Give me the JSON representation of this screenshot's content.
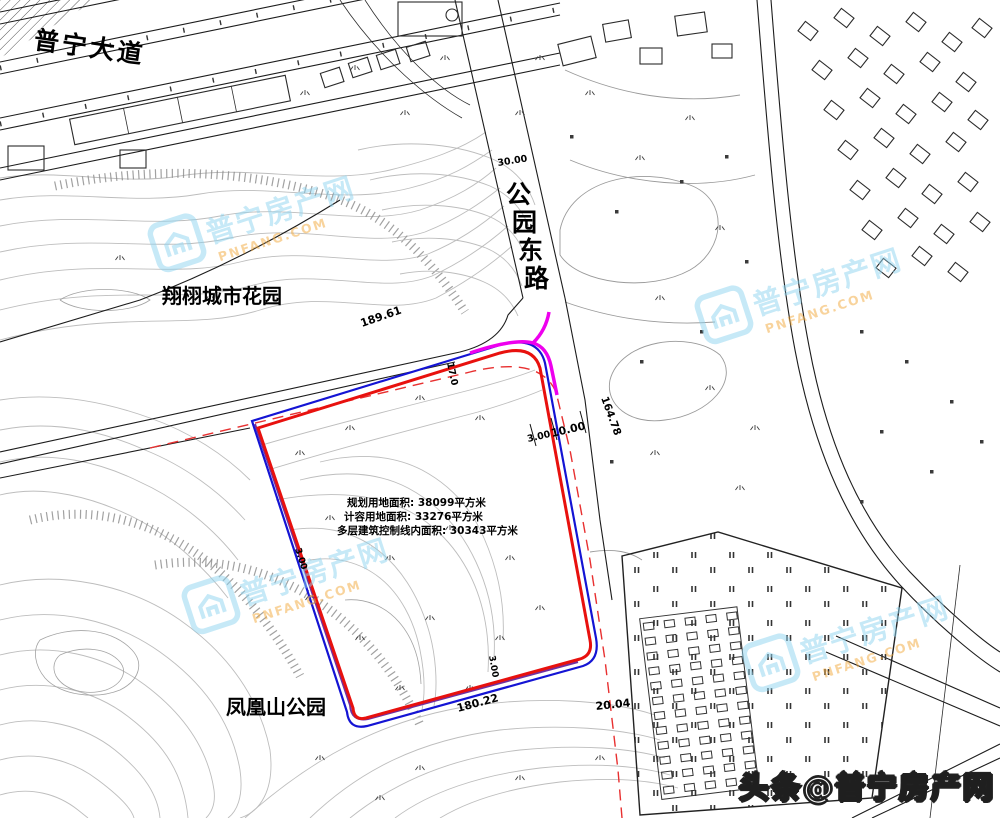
{
  "watermark": {
    "cn": "普宁房产网",
    "en": "PNFANG.COM"
  },
  "credit": {
    "text": "头条@普宁房产网"
  },
  "map": {
    "roads": {
      "puning_avenue": "普宁大道",
      "park_east_road_chars": [
        "公",
        "园",
        "东",
        "路"
      ]
    },
    "places": {
      "city_garden": "翔栩城市花园",
      "phoenix_park": "凤凰山公园"
    },
    "site_annotation": {
      "line1": "规划用地面积: 38099平方米",
      "line2": "计容用地面积: 33276平方米",
      "line3": "多层建筑控制线内面积: 30343平方米"
    },
    "dimensions": {
      "top_edge_length": "189.61",
      "road_width": "30.00",
      "setback_3": "3.00",
      "setback_10": "10.00",
      "east_edge_length": "164.78",
      "north_setback": "17.0",
      "west_setback": "3.00",
      "south_setback": "3.00",
      "south_edge_length": "180.22",
      "southeast_edge": "20.04"
    },
    "legend_colors": {
      "boundary_red": "#e8110e",
      "boundary_blue": "#1414d4",
      "control_magenta": "#ee00ee",
      "control_purple": "#7030a0",
      "centerline_red_dash": "#e83030",
      "watermark_blue": "#8fd4f0",
      "watermark_orange": "#f2a93c"
    }
  }
}
